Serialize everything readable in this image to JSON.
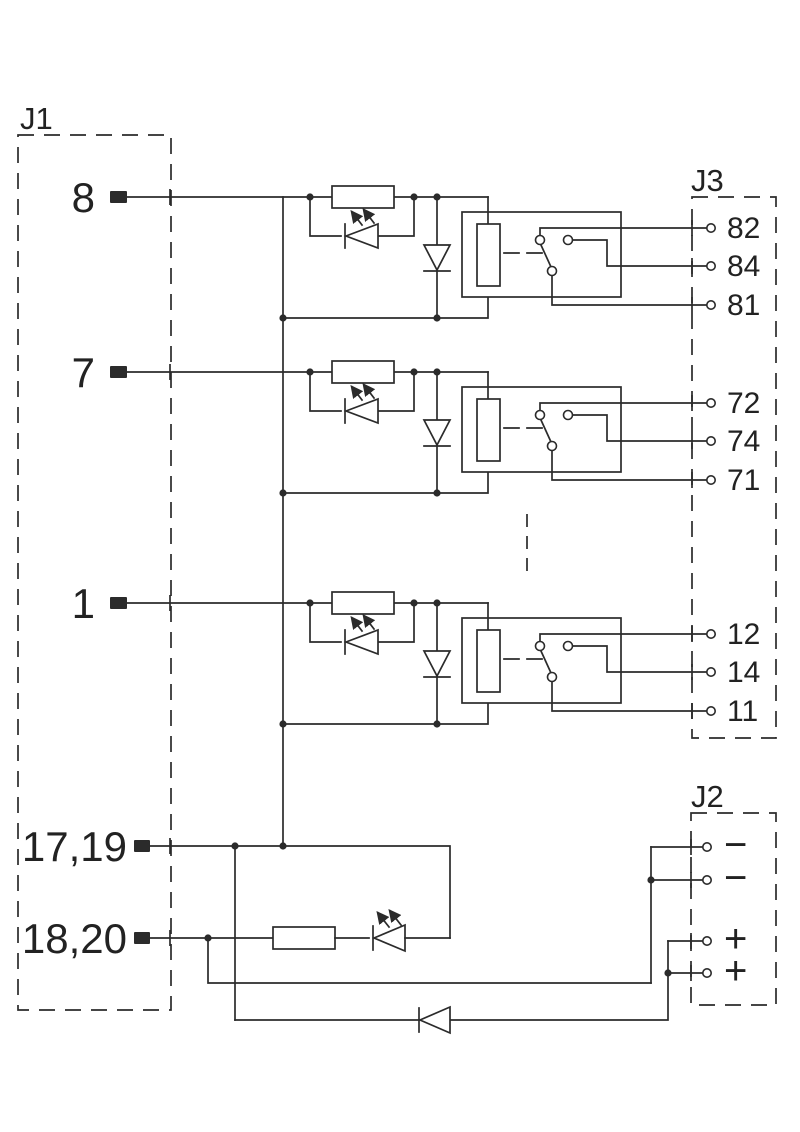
{
  "connectors": {
    "j1": {
      "label": "J1",
      "pins": [
        "8",
        "7",
        "1",
        "17,19",
        "18,20"
      ]
    },
    "j3": {
      "label": "J3",
      "pins": [
        "82",
        "84",
        "81",
        "72",
        "74",
        "71",
        "12",
        "14",
        "11"
      ]
    },
    "j2": {
      "label": "J2",
      "pins": [
        "−",
        "−",
        "+",
        "+"
      ]
    }
  },
  "colors": {
    "line": "#2b2b2b",
    "background": "#ffffff"
  }
}
